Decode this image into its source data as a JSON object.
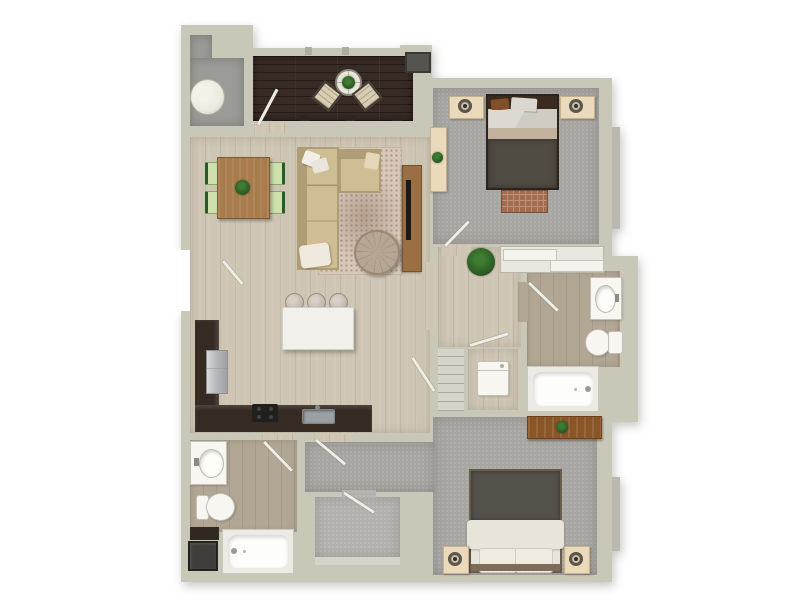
{
  "meta": {
    "description": "Top-down 3D rendered apartment floor plan, 2 bedroom / 2 bathroom unit with balcony, no text labels visible",
    "view": "floorplan-top-down"
  },
  "palette": {
    "bg": "#ffffff",
    "wall": "#c9c8b8",
    "wall_shadow": "#aeada0",
    "window": "#b9b9b1",
    "door_leaf": "#efeee6",
    "wood_floor": "#cec5b3",
    "bath_floor": "#b2a794",
    "carpet": "#a7a6a2",
    "carpet_light": "#b2b1ad",
    "utility_floor": "#9b9b97",
    "balcony_floor": "#382a24",
    "counter_dark": "#352b23",
    "island": "#f1f0eb",
    "stainless": "#b9bcbf",
    "appliance_dark": "#21201e",
    "fixture_white": "#f7f6f1",
    "fixture_edge": "#c2c1b7",
    "wood_table": "#a87c4d",
    "wood_console": "#9a6f43",
    "wood_dark": "#8a5527",
    "sofa": "#cfbd94",
    "sofa_trim": "#af9d75",
    "rug_living": "#d7c8bb",
    "rug_accent": "#ae9685",
    "rug_bedroom": "#a26c52",
    "chair_green": "#cde0ae",
    "chair_green_dark": "#2e5a28",
    "plant_green": "#3e7d31",
    "plant_dark": "#275220",
    "headboard": "#3a2b1e",
    "blanket_dark": "#4f4a42",
    "blanket_gray": "#55514b",
    "sheet": "#e8e4d9",
    "nightstand": "#ead9ba",
    "lamp_ring": "#5c564a",
    "papasan": "#b5a793",
    "heater": "#eceade",
    "washer_dark": "#3f3e3b",
    "shelf": "#d5d4c9",
    "tv_black": "#191919"
  },
  "rooms": [
    {
      "id": "utility-room",
      "name": "Utility Room",
      "floor": "utility_floor",
      "furniture": [
        "water-heater"
      ]
    },
    {
      "id": "balcony",
      "name": "Balcony",
      "floor": "balcony_floor",
      "furniture": [
        "round-bistro-table",
        "potted-plant",
        "patio-chair-left",
        "patio-chair-right",
        "wall-unit"
      ]
    },
    {
      "id": "bedroom-1",
      "name": "Bedroom 1",
      "floor": "carpet",
      "furniture": [
        "double-bed",
        "nightstand-left",
        "nightstand-right",
        "table-lamp-left",
        "table-lamp-right",
        "dresser",
        "potted-plant",
        "foot-rug",
        "window"
      ]
    },
    {
      "id": "living-dining-room",
      "name": "Living / Dining Room",
      "floor": "wood_floor",
      "furniture": [
        "dining-table",
        "dining-chairs-x4",
        "centerpiece-plant",
        "sectional-sofa",
        "throw-pillows",
        "area-rug",
        "round-lounge-chair",
        "media-console",
        "tv"
      ]
    },
    {
      "id": "kitchen",
      "name": "Kitchen",
      "floor": "wood_floor",
      "furniture": [
        "l-shaped-counter",
        "refrigerator",
        "range-cooktop",
        "kitchen-sink",
        "island",
        "bar-stools-x3"
      ]
    },
    {
      "id": "hallway",
      "name": "Hallway",
      "floor": "wood_floor",
      "furniture": [
        "potted-plant"
      ]
    },
    {
      "id": "hall-closet",
      "name": "Hall Closet",
      "floor": "wall",
      "furniture": [
        "sliding-doors"
      ]
    },
    {
      "id": "linen-closet",
      "name": "Linen Closet",
      "floor": "shelf",
      "furniture": [
        "shelves"
      ]
    },
    {
      "id": "laundry-closet",
      "name": "Laundry Closet",
      "floor": "wood_floor",
      "furniture": [
        "washer"
      ]
    },
    {
      "id": "bathroom-1",
      "name": "Bathroom 1",
      "floor": "bath_floor",
      "furniture": [
        "vanity-sink",
        "toilet",
        "bathtub"
      ]
    },
    {
      "id": "bedroom-2",
      "name": "Bedroom 2",
      "floor": "carpet",
      "furniture": [
        "double-bed",
        "nightstand-left",
        "nightstand-right",
        "table-lamp-left",
        "table-lamp-right",
        "dresser",
        "potted-plant",
        "window"
      ]
    },
    {
      "id": "walk-in-closet",
      "name": "Walk-in Closet",
      "floor": "carpet_light",
      "furniture": [
        "shelf"
      ]
    },
    {
      "id": "bathroom-2",
      "name": "Bathroom 2",
      "floor": "bath_floor",
      "furniture": [
        "vanity-sink",
        "toilet",
        "bathtub",
        "base-cabinet",
        "stacked-washer-dryer"
      ]
    },
    {
      "id": "entry",
      "name": "Entry",
      "floor": "wood_floor",
      "furniture": [
        "entry-door"
      ]
    }
  ]
}
